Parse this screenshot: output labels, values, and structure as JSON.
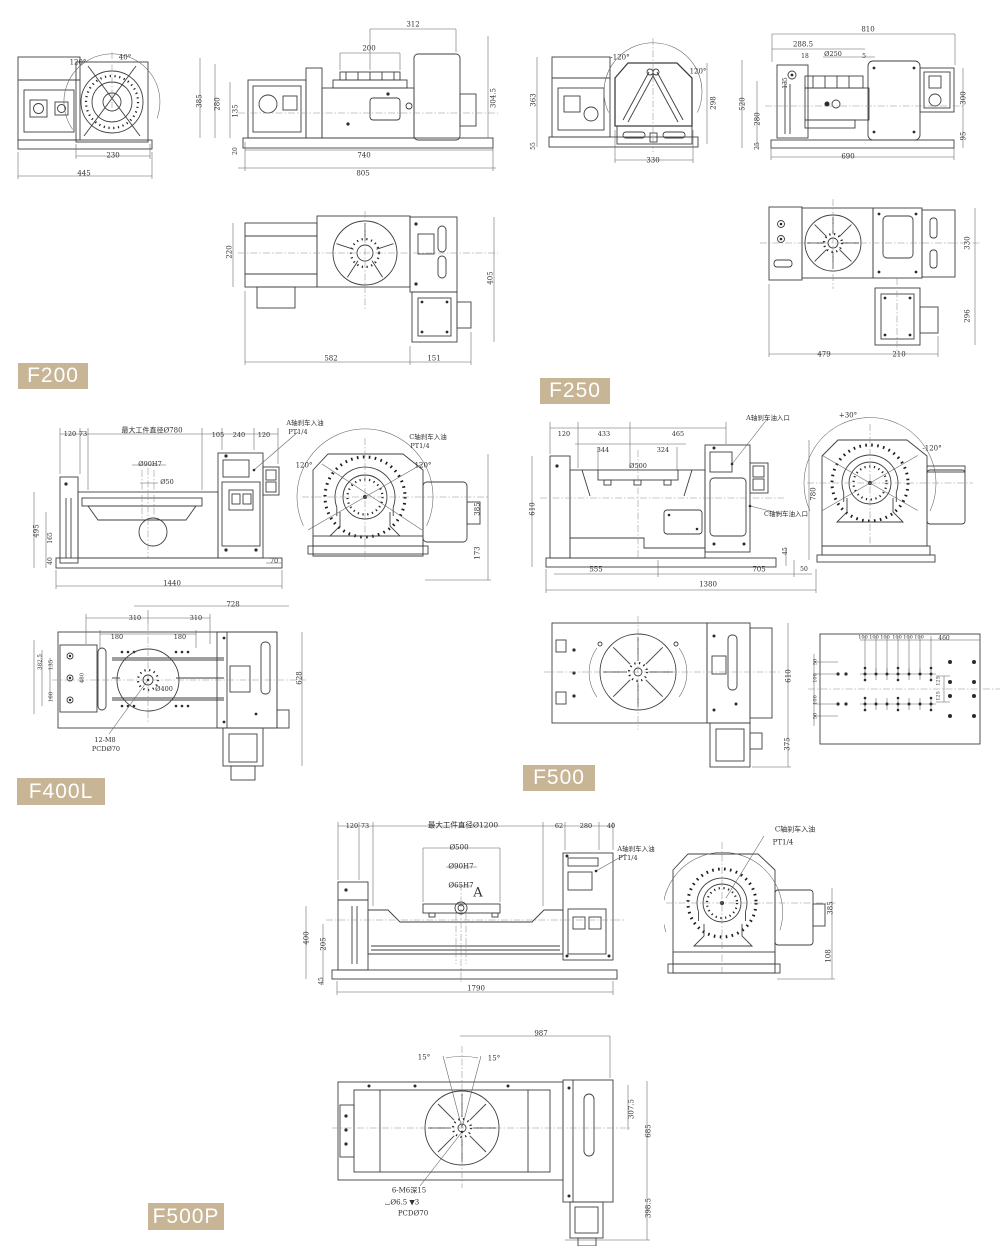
{
  "page": {
    "background": "#ffffff",
    "line_color": "#3f3f3f",
    "dim_text_color": "#2f2f2f"
  },
  "badge": {
    "background": "#c7b596",
    "text_color": "#ffffff"
  },
  "models": [
    {
      "label": "F200"
    },
    {
      "label": "F250"
    },
    {
      "label": "F400L"
    },
    {
      "label": "F500"
    },
    {
      "label": "F500P"
    }
  ],
  "dim_labels": [
    {
      "t": "120°",
      "x": 78,
      "y": 63
    },
    {
      "t": "40°",
      "x": 125,
      "y": 58
    },
    {
      "t": "230",
      "x": 113,
      "y": 156
    },
    {
      "t": "445",
      "x": 84,
      "y": 174
    },
    {
      "t": "312",
      "x": 413,
      "y": 25
    },
    {
      "t": "200",
      "x": 369,
      "y": 49
    },
    {
      "t": "385",
      "x": 200,
      "y": 101,
      "r": -90
    },
    {
      "t": "280",
      "x": 218,
      "y": 104,
      "r": -90
    },
    {
      "t": "135",
      "x": 236,
      "y": 111,
      "r": -90
    },
    {
      "t": "20",
      "x": 236,
      "y": 151,
      "r": -90,
      "s": 6
    },
    {
      "t": "304.5",
      "x": 494,
      "y": 98,
      "r": -90
    },
    {
      "t": "740",
      "x": 364,
      "y": 156
    },
    {
      "t": "805",
      "x": 363,
      "y": 174
    },
    {
      "t": "220",
      "x": 230,
      "y": 252,
      "r": -90
    },
    {
      "t": "582",
      "x": 331,
      "y": 359
    },
    {
      "t": "151",
      "x": 434,
      "y": 359
    },
    {
      "t": "405",
      "x": 491,
      "y": 278,
      "r": -90
    },
    {
      "t": "-120°",
      "x": 620,
      "y": 58
    },
    {
      "t": "120°",
      "x": 698,
      "y": 72
    },
    {
      "t": "363",
      "x": 534,
      "y": 100,
      "r": -90
    },
    {
      "t": "55",
      "x": 534,
      "y": 146,
      "r": -90,
      "s": 6
    },
    {
      "t": "298",
      "x": 714,
      "y": 103,
      "r": -90
    },
    {
      "t": "330",
      "x": 653,
      "y": 161
    },
    {
      "t": "810",
      "x": 868,
      "y": 30
    },
    {
      "t": "288.5",
      "x": 803,
      "y": 45
    },
    {
      "t": "18",
      "x": 805,
      "y": 57,
      "s": 6
    },
    {
      "t": "Ø250",
      "x": 833,
      "y": 54,
      "s": 6.5
    },
    {
      "t": "5",
      "x": 864,
      "y": 57,
      "s": 6
    },
    {
      "t": "520",
      "x": 743,
      "y": 104,
      "r": -90
    },
    {
      "t": "135",
      "x": 786,
      "y": 83,
      "r": -90,
      "s": 6
    },
    {
      "t": "280",
      "x": 758,
      "y": 119,
      "r": -90
    },
    {
      "t": "25",
      "x": 758,
      "y": 146,
      "r": -90,
      "s": 6
    },
    {
      "t": "300",
      "x": 964,
      "y": 98,
      "r": -90
    },
    {
      "t": "95",
      "x": 964,
      "y": 136,
      "r": -90
    },
    {
      "t": "690",
      "x": 848,
      "y": 157
    },
    {
      "t": "330",
      "x": 968,
      "y": 243,
      "r": -90
    },
    {
      "t": "296",
      "x": 968,
      "y": 316,
      "r": -90
    },
    {
      "t": "479",
      "x": 824,
      "y": 355
    },
    {
      "t": "210",
      "x": 899,
      "y": 355
    },
    {
      "t": "120",
      "x": 70,
      "y": 434,
      "s": 6.5
    },
    {
      "t": "73",
      "x": 83,
      "y": 434,
      "s": 6.5
    },
    {
      "t": "最大工件直径Ø780",
      "x": 152,
      "y": 431,
      "s": 7
    },
    {
      "t": "105",
      "x": 218,
      "y": 435,
      "s": 6.5
    },
    {
      "t": "240",
      "x": 239,
      "y": 435,
      "s": 6.5
    },
    {
      "t": "120",
      "x": 264,
      "y": 435,
      "s": 6.5
    },
    {
      "t": "A轴刹车入油",
      "x": 305,
      "y": 423,
      "s": 6.5
    },
    {
      "t": "PT1/4",
      "x": 298,
      "y": 432,
      "s": 6.5
    },
    {
      "t": "Ø90H7",
      "x": 150,
      "y": 464,
      "s": 6.5
    },
    {
      "t": "Ø50",
      "x": 167,
      "y": 482,
      "s": 6.5
    },
    {
      "t": "495",
      "x": 37,
      "y": 531,
      "r": -90
    },
    {
      "t": "165",
      "x": 51,
      "y": 538,
      "r": -90,
      "s": 6
    },
    {
      "t": "40",
      "x": 51,
      "y": 561,
      "r": -90,
      "s": 6
    },
    {
      "t": "70",
      "x": 274,
      "y": 561,
      "s": 6.5
    },
    {
      "t": "1440",
      "x": 172,
      "y": 584
    },
    {
      "t": "C轴刹车入油",
      "x": 428,
      "y": 437,
      "s": 6.5
    },
    {
      "t": "PT1/4",
      "x": 420,
      "y": 446,
      "s": 6.5
    },
    {
      "t": "120°",
      "x": 304,
      "y": 466
    },
    {
      "t": "120°",
      "x": 423,
      "y": 466
    },
    {
      "t": "385",
      "x": 478,
      "y": 509,
      "r": -90
    },
    {
      "t": "173",
      "x": 478,
      "y": 553,
      "r": -90
    },
    {
      "t": "728",
      "x": 233,
      "y": 605
    },
    {
      "t": "310",
      "x": 135,
      "y": 618,
      "s": 6.5
    },
    {
      "t": "310",
      "x": 196,
      "y": 618,
      "s": 6.5
    },
    {
      "t": "180",
      "x": 117,
      "y": 637,
      "s": 6.5
    },
    {
      "t": "180",
      "x": 180,
      "y": 637,
      "s": 6.5
    },
    {
      "t": "Ø400",
      "x": 164,
      "y": 689,
      "s": 6.5
    },
    {
      "t": "12-M8",
      "x": 105,
      "y": 740,
      "s": 6.5
    },
    {
      "t": "PCDØ70",
      "x": 106,
      "y": 749,
      "s": 6.5
    },
    {
      "t": "382.5",
      "x": 41,
      "y": 662,
      "r": -90,
      "s": 5.5
    },
    {
      "t": "135",
      "x": 52,
      "y": 665,
      "r": -90,
      "s": 5.5
    },
    {
      "t": "160",
      "x": 52,
      "y": 697,
      "r": -90,
      "s": 5.5
    },
    {
      "t": "480",
      "x": 83,
      "y": 678,
      "r": -90,
      "s": 5.5
    },
    {
      "t": "628",
      "x": 300,
      "y": 678,
      "r": -90
    },
    {
      "t": "120",
      "x": 564,
      "y": 434,
      "s": 6.5
    },
    {
      "t": "433",
      "x": 604,
      "y": 434,
      "s": 6.5
    },
    {
      "t": "465",
      "x": 678,
      "y": 434,
      "s": 6.5
    },
    {
      "t": "344",
      "x": 603,
      "y": 450,
      "s": 6.5
    },
    {
      "t": "324",
      "x": 663,
      "y": 450,
      "s": 6.5
    },
    {
      "t": "Ø500",
      "x": 638,
      "y": 466,
      "s": 6.5
    },
    {
      "t": "A轴刹车油入口",
      "x": 768,
      "y": 418,
      "s": 6.5
    },
    {
      "t": "C轴刹车油入口",
      "x": 786,
      "y": 514,
      "s": 6.5
    },
    {
      "t": "610",
      "x": 533,
      "y": 509,
      "r": -90
    },
    {
      "t": "45",
      "x": 786,
      "y": 551,
      "r": -90,
      "s": 6
    },
    {
      "t": "555",
      "x": 596,
      "y": 570
    },
    {
      "t": "705",
      "x": 759,
      "y": 570
    },
    {
      "t": "50",
      "x": 804,
      "y": 570,
      "s": 6
    },
    {
      "t": "1380",
      "x": 708,
      "y": 585
    },
    {
      "t": "+30°",
      "x": 848,
      "y": 416
    },
    {
      "t": "-120°",
      "x": 932,
      "y": 449
    },
    {
      "t": "780",
      "x": 814,
      "y": 494,
      "r": -90
    },
    {
      "t": "610",
      "x": 789,
      "y": 676,
      "r": -90
    },
    {
      "t": "375",
      "x": 788,
      "y": 744,
      "r": -90
    },
    {
      "t": "100",
      "x": 863,
      "y": 638,
      "s": 5
    },
    {
      "t": "100",
      "x": 874,
      "y": 638,
      "s": 5
    },
    {
      "t": "100",
      "x": 885,
      "y": 638,
      "s": 5
    },
    {
      "t": "100",
      "x": 897,
      "y": 638,
      "s": 5
    },
    {
      "t": "100",
      "x": 908,
      "y": 638,
      "s": 5
    },
    {
      "t": "100",
      "x": 919,
      "y": 638,
      "s": 5
    },
    {
      "t": "460",
      "x": 944,
      "y": 639,
      "s": 6
    },
    {
      "t": "125",
      "x": 939,
      "y": 681,
      "r": -90,
      "s": 5
    },
    {
      "t": "125",
      "x": 939,
      "y": 696,
      "r": -90,
      "s": 5
    },
    {
      "t": "50",
      "x": 816,
      "y": 662,
      "r": -90,
      "s": 5
    },
    {
      "t": "100",
      "x": 816,
      "y": 678,
      "r": -90,
      "s": 5
    },
    {
      "t": "100",
      "x": 816,
      "y": 700,
      "r": -90,
      "s": 5
    },
    {
      "t": "50",
      "x": 816,
      "y": 716,
      "r": -90,
      "s": 5
    },
    {
      "t": "120",
      "x": 352,
      "y": 826,
      "s": 6.5
    },
    {
      "t": "73",
      "x": 365,
      "y": 826,
      "s": 6.5
    },
    {
      "t": "最大工件直径Ø1200",
      "x": 463,
      "y": 825,
      "s": 7.5
    },
    {
      "t": "62",
      "x": 559,
      "y": 826,
      "s": 6.5
    },
    {
      "t": "280",
      "x": 586,
      "y": 826,
      "s": 6.5
    },
    {
      "t": "40",
      "x": 611,
      "y": 826,
      "s": 6.5
    },
    {
      "t": "Ø500",
      "x": 459,
      "y": 848,
      "s": 7
    },
    {
      "t": "Ø90H7",
      "x": 461,
      "y": 867,
      "s": 7
    },
    {
      "t": "Ø65H7",
      "x": 461,
      "y": 886,
      "s": 7
    },
    {
      "t": "A",
      "x": 478,
      "y": 893,
      "s": 13
    },
    {
      "t": "A轴刹车入油",
      "x": 636,
      "y": 849,
      "s": 6.5
    },
    {
      "t": "PT1/4",
      "x": 628,
      "y": 858,
      "s": 6.5
    },
    {
      "t": "400",
      "x": 307,
      "y": 938,
      "r": -90
    },
    {
      "t": "205",
      "x": 324,
      "y": 944,
      "r": -90
    },
    {
      "t": "45",
      "x": 322,
      "y": 981,
      "r": -90,
      "s": 6
    },
    {
      "t": "1790",
      "x": 476,
      "y": 989
    },
    {
      "t": "C轴刹车入油",
      "x": 795,
      "y": 830,
      "s": 7
    },
    {
      "t": "PT1/4",
      "x": 783,
      "y": 843,
      "s": 7
    },
    {
      "t": "385",
      "x": 831,
      "y": 908,
      "r": -90
    },
    {
      "t": "108",
      "x": 829,
      "y": 956,
      "r": -90
    },
    {
      "t": "987",
      "x": 541,
      "y": 1034
    },
    {
      "t": "15°",
      "x": 424,
      "y": 1058
    },
    {
      "t": "15°",
      "x": 494,
      "y": 1059
    },
    {
      "t": "6-M6深15",
      "x": 409,
      "y": 1191,
      "s": 7
    },
    {
      "t": "⌴Ø6.5 ▼3",
      "x": 402,
      "y": 1203,
      "s": 7
    },
    {
      "t": "PCDØ70",
      "x": 413,
      "y": 1214,
      "s": 7
    },
    {
      "t": "307.5",
      "x": 632,
      "y": 1109,
      "r": -90
    },
    {
      "t": "685",
      "x": 649,
      "y": 1131,
      "r": -90
    },
    {
      "t": "398.5",
      "x": 649,
      "y": 1208,
      "r": -90
    }
  ]
}
